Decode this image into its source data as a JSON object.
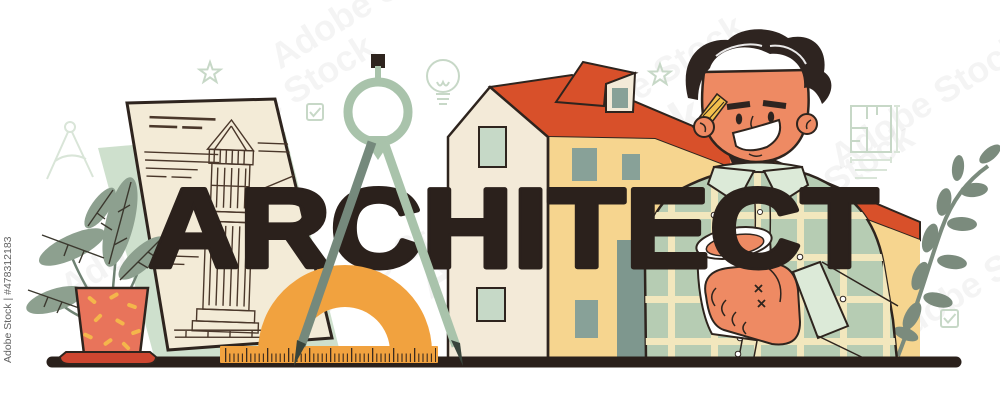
{
  "artwork": {
    "headline": "ARCHITECT",
    "watermark_text": "Adobe Stock",
    "watermark_id_text": "Adobe Stock | #478312183",
    "subject": "Typographic header illustration: architect with coffee cup, house, drafting tools, blueprint and plants"
  },
  "colors": {
    "ink": "#2e241e",
    "headline": "#2b211c",
    "paper_cream": "#f3ebd7",
    "sheet_green": "#cee0cd",
    "house_cream": "#f3ead8",
    "house_wall_yellow": "#f6d58f",
    "roof_red": "#d8502a",
    "window_mint": "#c6d9c7",
    "window_gray_green": "#88a198",
    "door_gray_green": "#7e978e",
    "compass_sage": "#a9c3ab",
    "compass_leg_dark": "#75897c",
    "compass_tip_dark": "#39453c",
    "protractor_orange": "#f1a23f",
    "ruler_orange": "#f1a23f",
    "skin_salmon": "#ee8a63",
    "hair_dark": "#2e2420",
    "shirt_sage": "#b6ccb3",
    "plaid_cream": "#f2e7bd",
    "collar_mint": "#dcead8",
    "pencil_yellow": "#f3c04c",
    "cup_white": "#ffffff",
    "pot_coral": "#e8745b",
    "saucer_red": "#ce4630",
    "sprinkle_yellow": "#f4b64b",
    "leaf_green": "#8da08f",
    "branch_green": "#7b8b7d",
    "faint_icon_green": "#c7d8c7",
    "ground_dark": "#2a201b"
  },
  "icons": {
    "star-icon": "five point star outline (2x)",
    "checkbox-check-icon": "square with check mark (2x)",
    "lightbulb-icon": "idea bulb outline",
    "floor-plan-icon": "apartment floor plan sketch",
    "divider-icon": "faint drafting divider outline",
    "drafting-compass": "large sage drafting divider",
    "protractor": "orange half-circle protractor",
    "ruler": "orange ruler with tick marks",
    "pencil-icon": "pencil behind ear",
    "coffee-cup": "white cup with coffee",
    "blueprint-sheet": "tilted sheet with tower sketch",
    "potted-plant": "coral pot with leaves",
    "branch-decor": "leafy branch"
  }
}
